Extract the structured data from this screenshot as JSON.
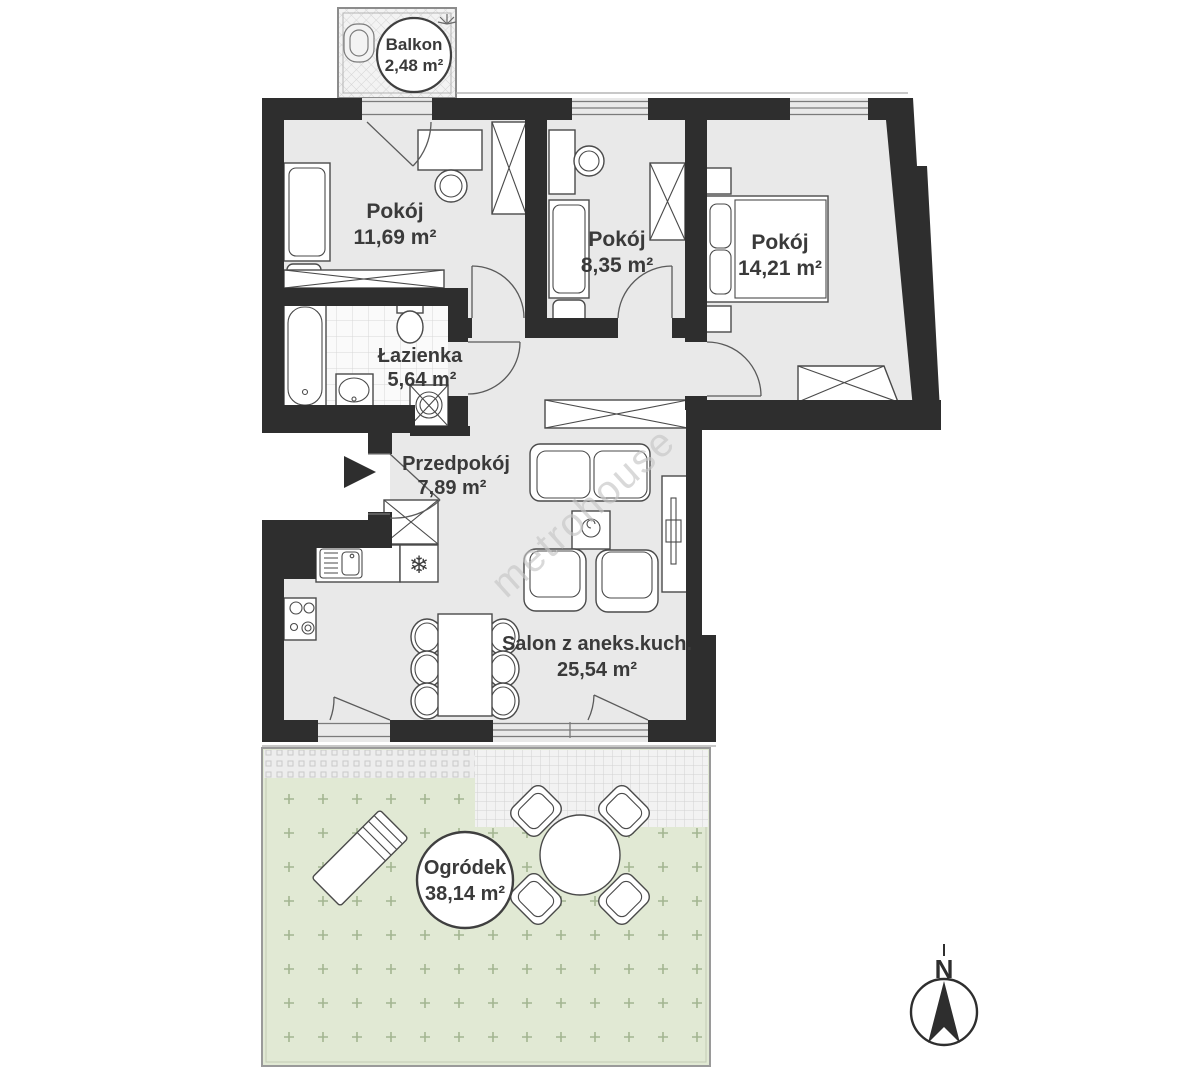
{
  "rooms": {
    "balcony": {
      "name": "Balkon",
      "area": "2,48 m²"
    },
    "room1": {
      "name": "Pokój",
      "area": "11,69 m²"
    },
    "room2": {
      "name": "Pokój",
      "area": "8,35 m²"
    },
    "room3": {
      "name": "Pokój",
      "area": "14,21 m²"
    },
    "bathroom": {
      "name": "Łazienka",
      "area": "5,64 m²"
    },
    "hallway": {
      "name": "Przedpokój",
      "area": "7,89 m²"
    },
    "living_room": {
      "name": "Salon z aneks.kuch.",
      "area": "25,54 m²"
    },
    "garden": {
      "name": "Ogródek",
      "area": "38,14 m²"
    }
  },
  "compass": {
    "north": "N"
  },
  "watermark": "metrohouse",
  "colors": {
    "wall": "#2e2e2e",
    "floor": "#e9e9e9",
    "garden_fill": "#e0e9d3",
    "label_text": "#3a3a3a"
  }
}
